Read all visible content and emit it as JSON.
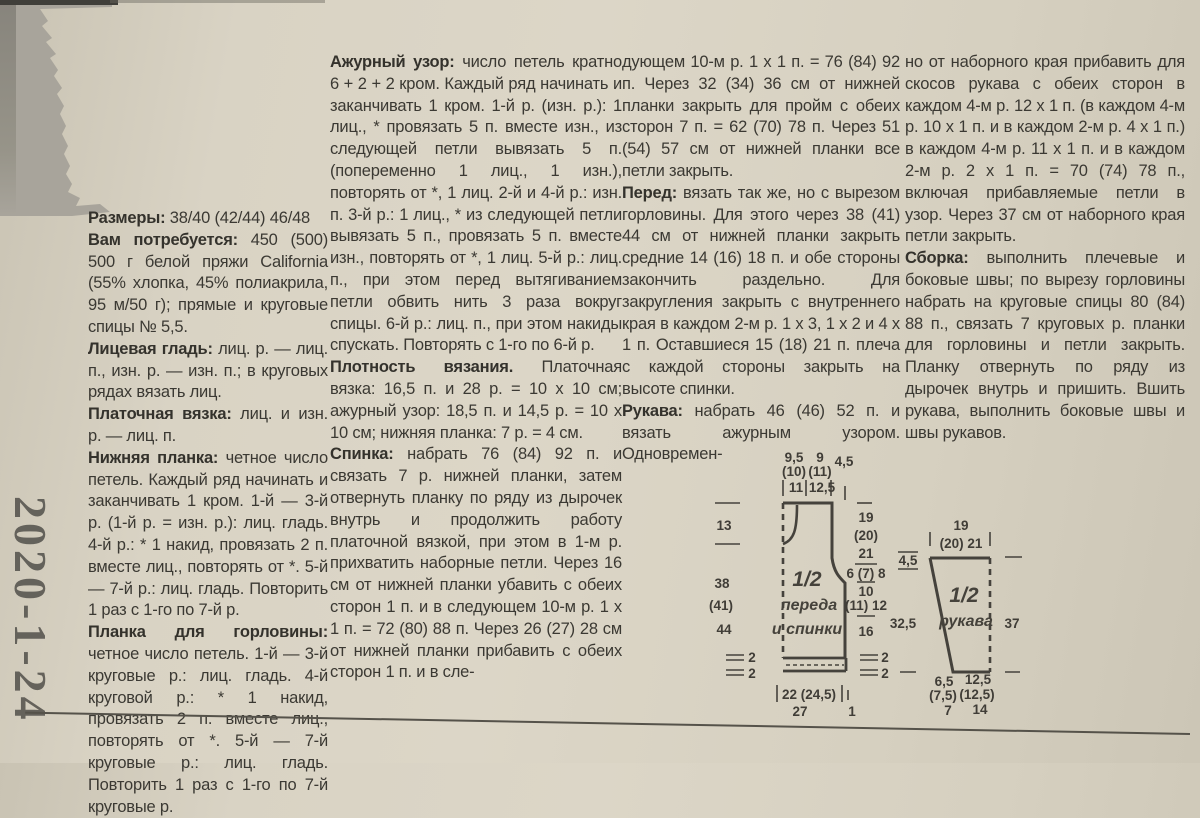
{
  "stamp": "2020-1-24",
  "columns": [
    {
      "paragraphs": [
        {
          "label": "Размеры:",
          "text": "38/40 (42/44) 46/48"
        },
        {
          "label": "Вам потребуется:",
          "text": "450 (500) 500 г белой пряжи California (55% хлопка, 45% полиакрила, 95 м/50 г); прямые и круговые спицы № 5,5."
        },
        {
          "label": "Лицевая гладь:",
          "text": "лиц. р. — лиц. п., изн. р. — изн. п.; в круговых рядах вязать лиц."
        },
        {
          "label": "Платочная вязка:",
          "text": "лиц. и изн. р. — лиц. п."
        },
        {
          "label": "Нижняя планка:",
          "text": "четное число петель. Каждый ряд начинать и заканчивать 1 кром. 1-й — 3-й р. (1-й р. = изн. р.): лиц. гладь. 4-й р.: * 1 накид, провязать 2 п. вместе лиц., повторять от *. 5-й — 7-й р.: лиц. гладь. Повторить 1 раз с 1-го по 7-й р."
        },
        {
          "label": "Планка для горловины:",
          "text": "четное число петель. 1-й — 3-й круговые р.: лиц. гладь. 4-й круговой р.: * 1 накид, провязать 2 п. вместе лиц., повторять от *. 5-й — 7-й круговые р.: лиц. гладь. Повторить 1 раз с 1-го по 7-й круговые р."
        }
      ]
    },
    {
      "paragraphs": [
        {
          "label": "Ажурный узор:",
          "text": "число петель кратно 6 + 2 + 2 кром. Каждый ряд начинать и заканчивать 1 кром. 1-й р. (изн. р.): 1 лиц., * провязать 5 п. вместе изн., из следующей петли вывязать 5 п. (попеременно 1 лиц., 1 изн.), повторять от *, 1 лиц. 2-й и 4-й р.: изн. п. 3-й р.: 1 лиц., * из следующей петли вывязать 5 п., провязать 5 п. вместе изн., повторять от *, 1 лиц. 5-й р.: лиц. п., при этом перед вытягиванием петли обвить нить 3 раза вокруг спицы. 6-й р.: лиц. п., при этом накиды спускать. Повторять с 1-го по 6-й р."
        },
        {
          "label": "Плотность вязания.",
          "text": "Платочная вязка: 16,5 п. и 28 р. = 10 х 10 см; ажурный узор: 18,5 п. и 14,5 р. = 10 х 10 см; нижняя планка: 7 р. = 4 см."
        },
        {
          "label": "Спинка:",
          "text": "набрать 76 (84) 92 п. и связать 7 р. нижней планки, затем отвернуть планку по ряду из дырочек внутрь и продолжить работу платочной вязкой, при этом в 1-м р. прихватить наборные петли. Через 16 см от нижней планки убавить с обеих сторон 1 п. и в следующем 10-м р. 1 х 1 п. = 72 (80) 88 п. Через 26 (27) 28 см от нижней планки прибавить с обеих сторон 1 п. и в сле-"
        }
      ]
    },
    {
      "paragraphs": [
        {
          "label": "",
          "text": "дующем 10-м р. 1 х 1 п. = 76 (84) 92 п. Через 32 (34) 36 см от нижней планки закрыть для пройм с обеих сторон 7 п. = 62 (70) 78 п. Через 51 (54) 57 см от нижней планки все петли закрыть."
        },
        {
          "label": "Перед:",
          "text": "вязать так же, но с вырезом горловины. Для этого через 38 (41) 44 см от нижней планки закрыть средние 14 (16) 18 п. и обе стороны закончить раздельно. Для закругления закрыть с внутреннего края в каждом 2-м р. 1 х 3, 1 х 2 и 4 х 1 п. Оставшиеся 15 (18) 21 п. плеча с каждой стороны закрыть на высоте спинки."
        },
        {
          "label": "Рукава:",
          "text": "набрать 46 (46) 52 п. и вязать ажурным узором. Одновремен-"
        }
      ]
    },
    {
      "paragraphs": [
        {
          "label": "",
          "text": "но от наборного края прибавить для скосов рукава с обеих сторон в каждом 4-м р. 12 х 1 п. (в каждом 4-м р. 10 х 1 п. и в каждом 2-м р. 4 х 1 п.) в каждом 4-м р. 11 х 1 п. и в каждом 2-м р. 2 х 1 п. = 70 (74) 78 п., включая прибавляемые петли в узор. Через 37 см от наборного края петли закрыть."
        },
        {
          "label": "Сборка:",
          "text": "выполнить плечевые и боковые швы; по вырезу горловины набрать на круговые спицы 80 (84) 88 п., связать 7 круговых р. планки для горловины и петли закрыть. Планку отвернуть по ряду из дырочек внутрь и пришить. Вшить рукава, выполнить боковые швы и швы рукавов."
        }
      ]
    }
  ],
  "diagram": {
    "body": {
      "label_fraction": "1/2",
      "label_line1": "переда",
      "label_line2": "и спинки",
      "top1a": "9,5",
      "top1b": "(10)",
      "top1c": "11",
      "top2a": "9",
      "top2b": "(11)",
      "top2c": "12,5",
      "top3": "4,5",
      "neck_depth": "13",
      "side_a": "38",
      "side_b": "(41)",
      "side_c": "44",
      "shoulder_a": "19",
      "shoulder_b": "(20)",
      "shoulder_c": "21",
      "armhole_a": "6 (7) 8",
      "armhole_b": "10",
      "armhole_c": "(11) 12",
      "side_lower": "16",
      "hem_l1": "2",
      "hem_l2": "2",
      "hem_r1": "2",
      "hem_r2": "2",
      "bottom_a": "22 (24,5)",
      "bottom_b": "27",
      "bottom_corner": "1"
    },
    "sleeve": {
      "label_fraction": "1/2",
      "label": "рукава",
      "top_a": "19",
      "top_b": "(20) 21",
      "cap": "4,5",
      "left": "32,5",
      "right": "37",
      "bl_a": "6,5",
      "bl_b": "(7,5)",
      "bl_c": "7",
      "br_a": "12,5",
      "br_b": "(12,5)",
      "br_c": "14"
    }
  }
}
